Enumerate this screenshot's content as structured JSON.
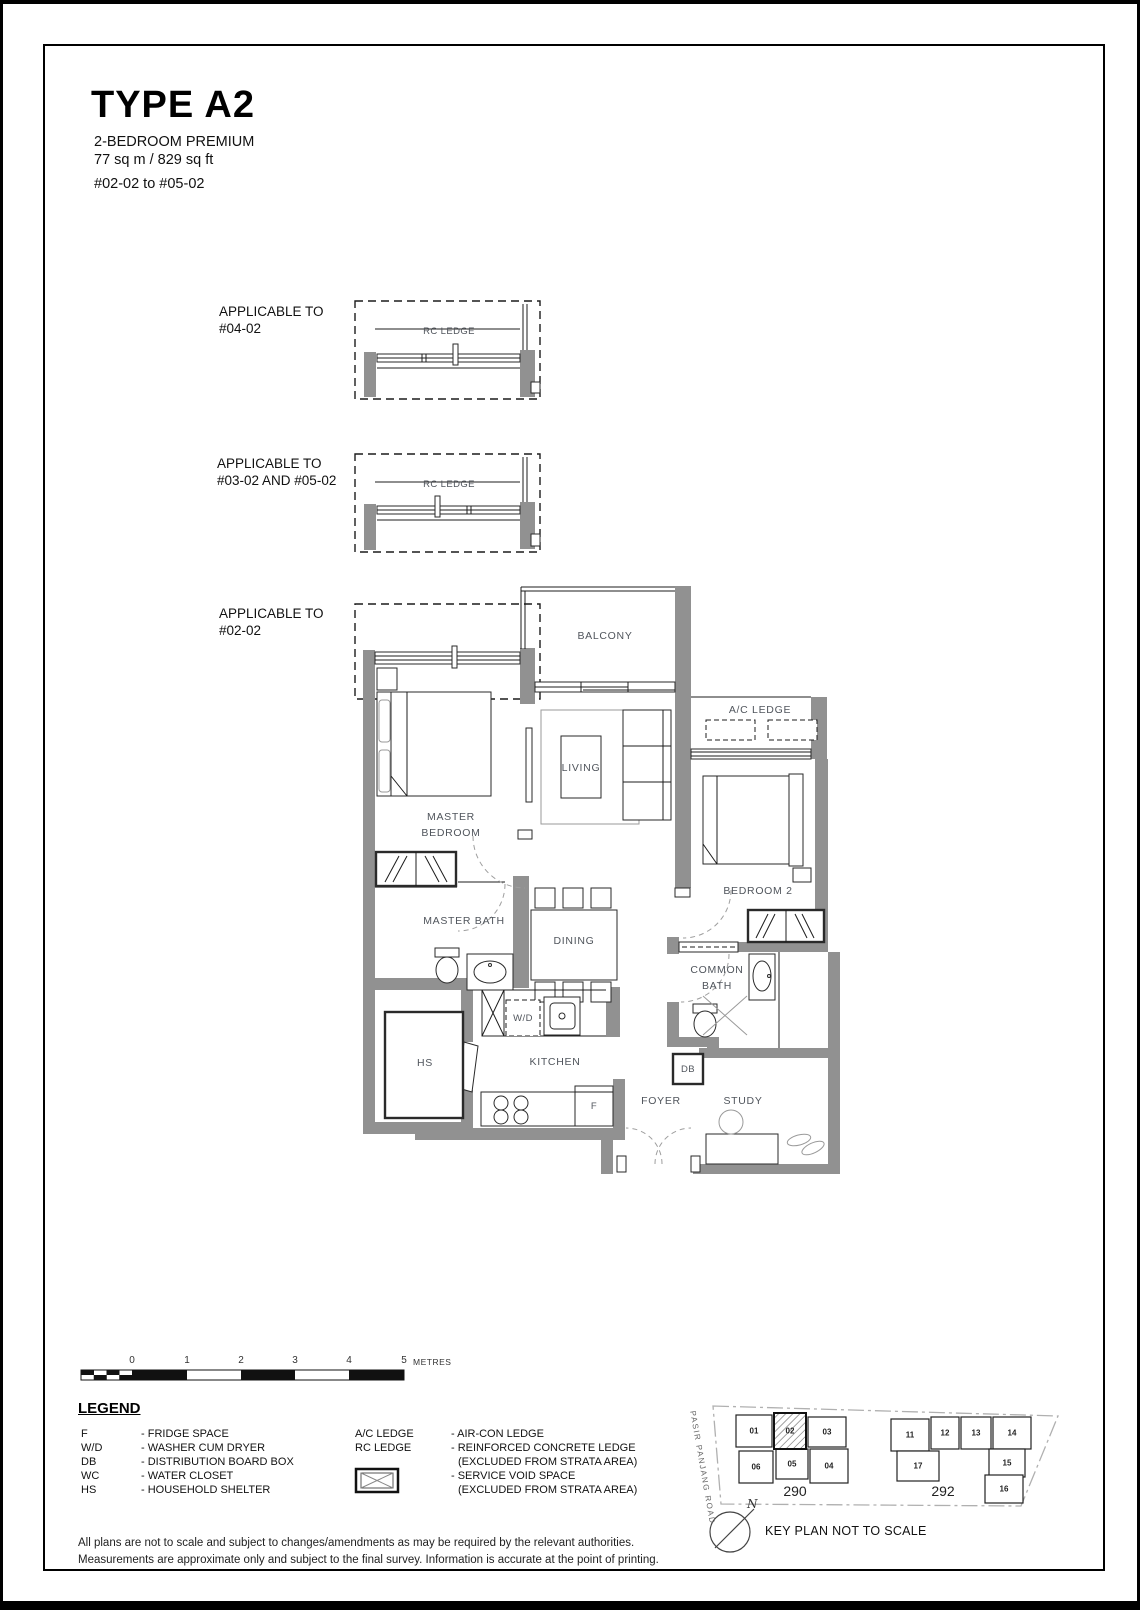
{
  "header": {
    "title": "TYPE A2",
    "subtitle": "2-BEDROOM PREMIUM",
    "area": "77 sq m / 829 sq ft",
    "units": "#02-02 to #05-02"
  },
  "variants": [
    {
      "line1": "APPLICABLE TO",
      "line2": "#04-02",
      "ledge": "RC LEDGE"
    },
    {
      "line1": "APPLICABLE TO",
      "line2": "#03-02 AND #05-02",
      "ledge": "RC LEDGE"
    },
    {
      "line1": "APPLICABLE TO",
      "line2": "#02-02"
    }
  ],
  "plan_labels": {
    "balcony": "BALCONY",
    "ac_ledge": "A/C LEDGE",
    "living": "LIVING",
    "master_bedroom_1": "MASTER",
    "master_bedroom_2": "BEDROOM",
    "bedroom2": "BEDROOM 2",
    "master_bath": "MASTER BATH",
    "dining": "DINING",
    "common_bath_1": "COMMON",
    "common_bath_2": "BATH",
    "wd": "W/D",
    "hs": "HS",
    "kitchen": "KITCHEN",
    "db": "DB",
    "fridge": "F",
    "foyer": "FOYER",
    "study": "STUDY"
  },
  "scale_bar": {
    "ticks": [
      "0",
      "1",
      "2",
      "3",
      "4",
      "5"
    ],
    "unit": "METRES"
  },
  "legend": {
    "heading": "LEGEND",
    "left": [
      {
        "t": "F",
        "d": "- FRIDGE SPACE"
      },
      {
        "t": "W/D",
        "d": "- WASHER CUM DRYER"
      },
      {
        "t": "DB",
        "d": "- DISTRIBUTION BOARD BOX"
      },
      {
        "t": "WC",
        "d": "- WATER CLOSET"
      },
      {
        "t": "HS",
        "d": "- HOUSEHOLD SHELTER"
      }
    ],
    "right": {
      "t1": "A/C LEDGE",
      "d1": "- AIR-CON LEDGE",
      "t2": "RC LEDGE",
      "d2": "- REINFORCED CONCRETE LEDGE",
      "d2b": "(EXCLUDED FROM STRATA AREA)",
      "d3": "- SERVICE VOID SPACE",
      "d3b": "(EXCLUDED FROM STRATA AREA)"
    }
  },
  "key_plan": {
    "road": "PASIR PANJANG ROAD",
    "north": "N",
    "caption": "KEY PLAN NOT TO SCALE",
    "block1_label": "290",
    "block2_label": "292",
    "block1_units": [
      "01",
      "02",
      "03",
      "06",
      "05",
      "04"
    ],
    "block2_units": [
      "11",
      "12",
      "13",
      "14",
      "17",
      "15",
      "16"
    ],
    "highlighted_unit": "02"
  },
  "footer": {
    "line1": "All plans are not to scale and subject to changes/amendments as may be required by the relevant authorities.",
    "line2": "Measurements are approximate only and subject to the final survey. Information is accurate at the point of printing."
  },
  "colors": {
    "wall_gray": "#919191"
  }
}
